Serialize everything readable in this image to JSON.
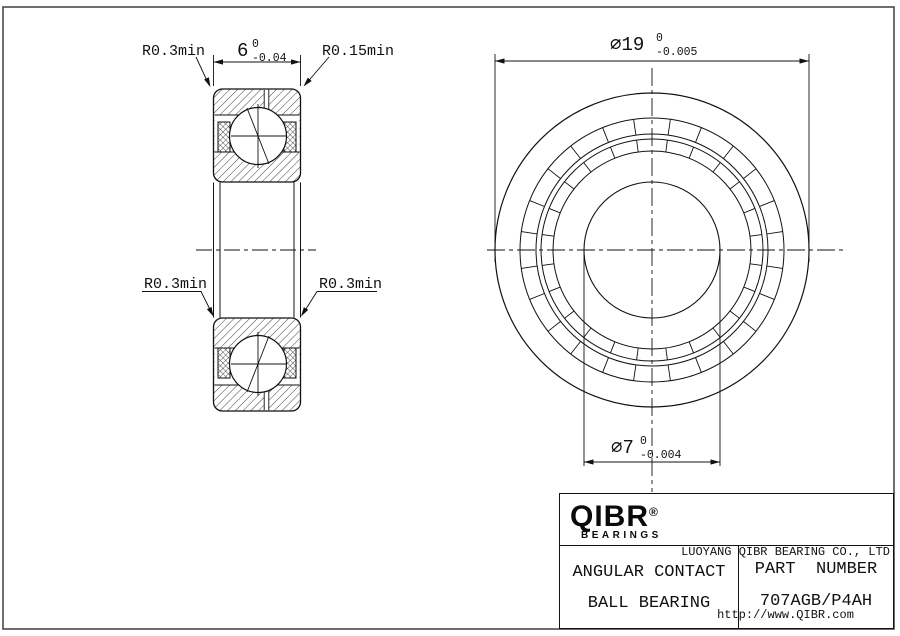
{
  "dims": {
    "width": {
      "value": "6",
      "tol_top": "0",
      "tol_bottom": "-0.04"
    },
    "outer_dia": {
      "value": "∅19",
      "tol_top": "0",
      "tol_bottom": "-0.005"
    },
    "bore_dia": {
      "value": "∅7",
      "tol_top": "0",
      "tol_bottom": "-0.004"
    },
    "fillet_top_left": "R0.3min",
    "fillet_top_right": "R0.15min",
    "fillet_mid_left": "R0.3min",
    "fillet_mid_right": "R0.3min"
  },
  "title_block": {
    "logo_text": "QIBR",
    "logo_reg": "®",
    "logo_bearings": "BEARINGS",
    "company": "LUOYANG QIBR BEARING CO., LTD",
    "website": "http://www.QIBR.com",
    "product_line1": "ANGULAR CONTACT",
    "product_line2": "BALL BEARING",
    "part_label": "PART  NUMBER",
    "part_number": "707AGB/P4AH"
  },
  "colors": {
    "line": "#111111",
    "frame": "#4a4a4a"
  }
}
